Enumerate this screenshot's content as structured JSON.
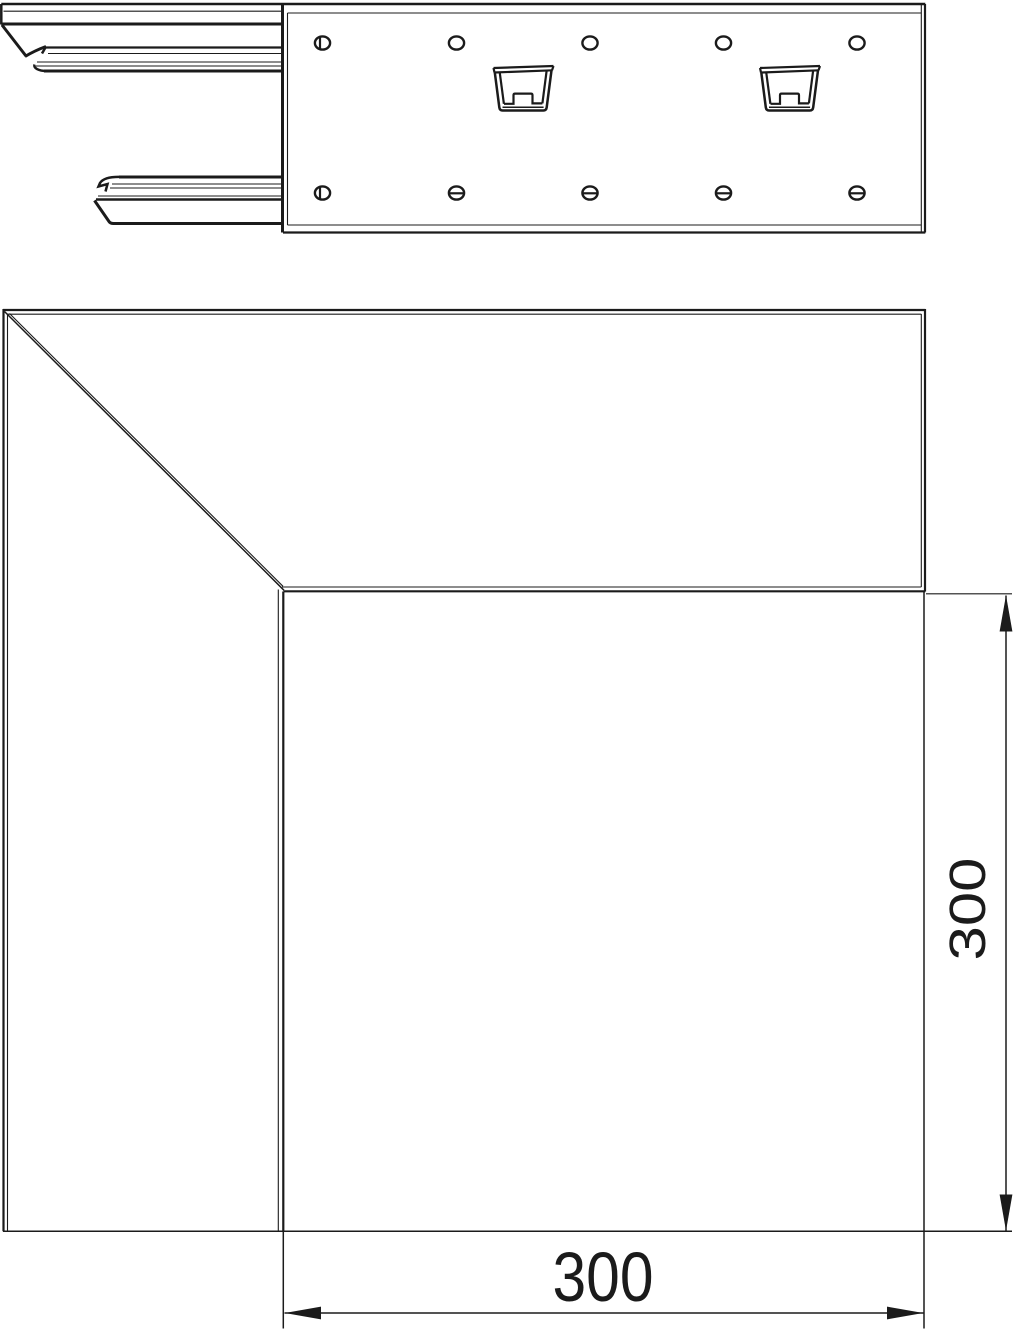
{
  "drawing": {
    "title": "Internal corner – technical drawing",
    "views": {
      "side_view": "profile section with mounting plate, screw holes and snap clips",
      "plan_view": "L-shaped internal corner with mitre line"
    },
    "dimensions": {
      "horizontal": {
        "value": "300"
      },
      "vertical": {
        "value": "300"
      }
    },
    "colors": {
      "line": "#1b1b1b",
      "background": "#ffffff"
    }
  }
}
